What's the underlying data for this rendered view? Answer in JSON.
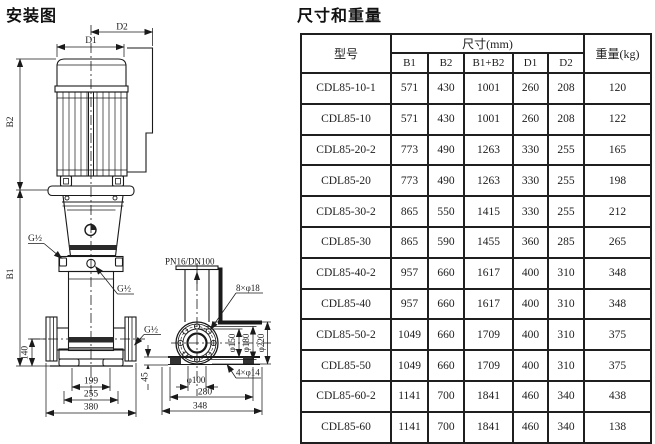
{
  "ink_color": "#1a1a1a",
  "background_color": "#ffffff",
  "diagram": {
    "title": "安装图",
    "labels": {
      "d1": "D1",
      "d2": "D2",
      "b1": "B1",
      "b2": "B2",
      "g_half": "G½",
      "dim140": "140",
      "dim199": "199",
      "dim255": "255",
      "dim380": "380",
      "pn": "PN16/DN100",
      "bolts8": "8×φ18",
      "dia150": "φ150",
      "dia180": "φ180",
      "dia220": "φ220",
      "bolts4": "4×φ14",
      "dia100": "φ100",
      "dim280": "280",
      "dim348": "348",
      "dim45": "45"
    }
  },
  "table": {
    "title": "尺寸和重量",
    "header": {
      "model": "型号",
      "size_group": "尺寸(mm)",
      "weight": "重量(kg)",
      "size_cols": [
        "B1",
        "B2",
        "B1+B2",
        "D1",
        "D2"
      ]
    },
    "rows": [
      [
        "CDL85-10-1",
        "571",
        "430",
        "1001",
        "260",
        "208",
        "120"
      ],
      [
        "CDL85-10",
        "571",
        "430",
        "1001",
        "260",
        "208",
        "122"
      ],
      [
        "CDL85-20-2",
        "773",
        "490",
        "1263",
        "330",
        "255",
        "165"
      ],
      [
        "CDL85-20",
        "773",
        "490",
        "1263",
        "330",
        "255",
        "198"
      ],
      [
        "CDL85-30-2",
        "865",
        "550",
        "1415",
        "330",
        "255",
        "212"
      ],
      [
        "CDL85-30",
        "865",
        "590",
        "1455",
        "360",
        "285",
        "265"
      ],
      [
        "CDL85-40-2",
        "957",
        "660",
        "1617",
        "400",
        "310",
        "348"
      ],
      [
        "CDL85-40",
        "957",
        "660",
        "1617",
        "400",
        "310",
        "348"
      ],
      [
        "CDL85-50-2",
        "1049",
        "660",
        "1709",
        "400",
        "310",
        "375"
      ],
      [
        "CDL85-50",
        "1049",
        "660",
        "1709",
        "400",
        "310",
        "375"
      ],
      [
        "CDL85-60-2",
        "1141",
        "700",
        "1841",
        "460",
        "340",
        "438"
      ],
      [
        "CDL85-60",
        "1141",
        "700",
        "1841",
        "460",
        "340",
        "138"
      ]
    ]
  }
}
